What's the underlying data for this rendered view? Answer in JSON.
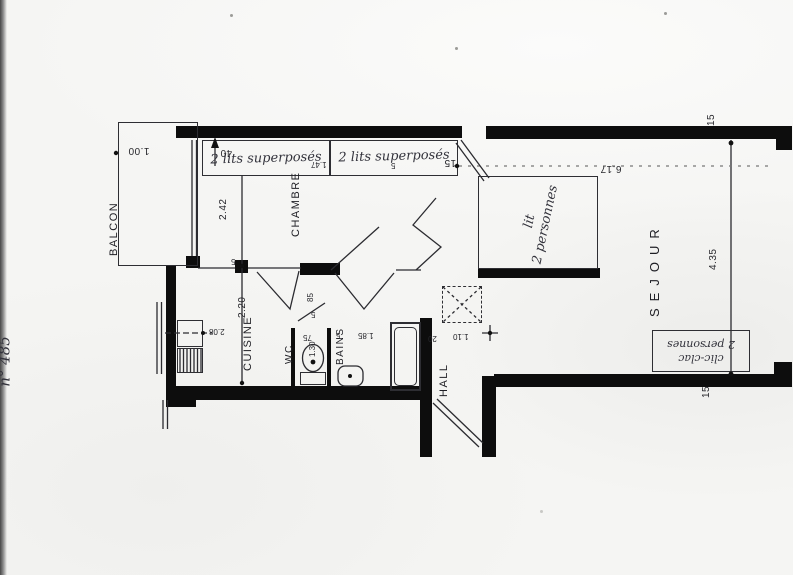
{
  "note": {
    "line1": "\" Les Aiguilles \"",
    "line2": "Immeuble III",
    "line3": "n° 485"
  },
  "rooms": {
    "balcon": "BALCON",
    "chambre": "CHAMBRE",
    "cuisine": "CUISINE",
    "wc": "WC",
    "bains": "BAINS",
    "hall": "HALL",
    "sejour": "SEJOUR"
  },
  "furniture": {
    "bunk1": "2 lits superposés",
    "bunk2": "2 lits superposés",
    "bed_line1": "lit",
    "bed_line2": "2 personnes",
    "sofa_line1": "clic-clac",
    "sofa_line2": "2 personnes"
  },
  "dims": {
    "balcon_width": "1.00",
    "balcon_door": "40",
    "chambre_depth": "2.42",
    "bunk_length": "1.47",
    "bunk_tick": "5",
    "gap_tick": "15",
    "sejour_length": "6.17",
    "sejour_width": "4.35",
    "sejour_tick_top": "15",
    "sejour_tick_bottom": "15",
    "cuisine_depth": "2.20",
    "counter_width": "2.08",
    "cuisine_tick": "5",
    "wc_door": "85",
    "wc_tick": "5",
    "wc_width": "75",
    "wc_depth": "1.30",
    "bains_tick": "5",
    "bains_width": "1.85",
    "hall_tick": "20",
    "hall_width": "1.10"
  }
}
